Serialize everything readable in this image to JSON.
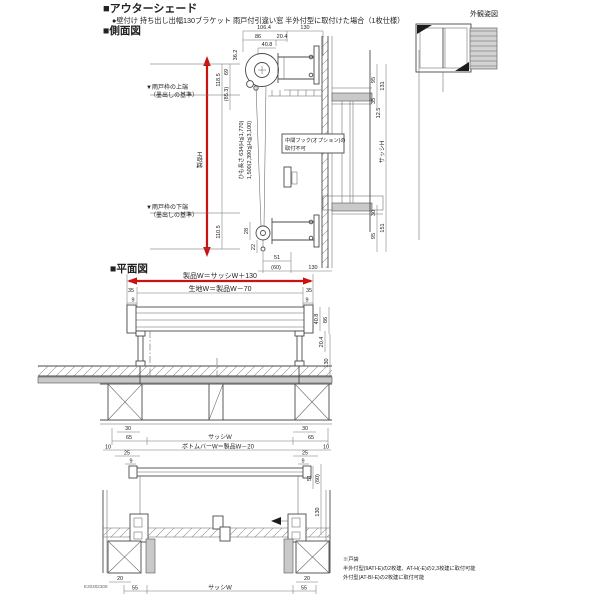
{
  "header": {
    "title": "■アウターシェード",
    "subtitle": "●壁付け 持ち出し出幅130ブラケット 雨戸付引違い窓 半外付型に取付けた場合（1枚仕様）",
    "side_section": "■側面図",
    "plan_section": "■平面図"
  },
  "appearance": {
    "label": "外観姿図"
  },
  "side": {
    "top_total": "106.4",
    "top_offset": "130",
    "top_86": "86",
    "top_20_4": "20.4",
    "top_40_8": "40.8",
    "left_36_2": "36.2",
    "left_118_5": "118.5",
    "left_69": "69",
    "left_85_3": "(85.3)",
    "left_110_5": "110.5",
    "product_h": "製品H",
    "sash_h": "サッシH",
    "datum_top_1": "▼雨戸枠の上端",
    "datum_top_2": "（墨出しの基準）",
    "datum_bottom_1": "▼雨戸枠の下端",
    "datum_bottom_2": "（墨出しの基準）",
    "cord_1": "ひも長さ 634(H≦1,770)",
    "cord_2": "1,500(2,390≦H≦3,100)",
    "hook_1": "中間フック(オプション)の",
    "hook_2": "取付不可",
    "right_95": "95",
    "right_131": "131",
    "right_35": "35",
    "right_12_5": "12.5",
    "right_30": "30",
    "right_151": "151",
    "right_95b": "95",
    "dim_28": "28",
    "dim_22": "22",
    "dim_51": "51",
    "dim_60": "(60)",
    "dim_130": "130"
  },
  "plan": {
    "product_w": "製品W＝サッシW＋130",
    "fabric_w": "生地W＝製品W－70",
    "l35": "35",
    "r35": "35",
    "l9": "9",
    "r9": "9",
    "r40_8": "40.8",
    "r86": "86",
    "r20_4": "20.4",
    "r130": "130",
    "l30": "30",
    "r30": "30",
    "l65": "65",
    "r65": "65",
    "sash_w": "サッシW",
    "l10": "10",
    "r10": "10",
    "bottom_bar": "ボトムバーW＝製品W－20",
    "l25": "25",
    "r25": "25",
    "l9b": "9",
    "r9b": "9",
    "r51": "51",
    "r60": "(60)",
    "r130b": "130",
    "l20": "20",
    "r20": "20",
    "l55": "55",
    "r55": "55",
    "sash_w_b": "サッシW",
    "code": "E20302308"
  },
  "notes": {
    "l1": "※戸袋",
    "l2": "半外付型(9ATI-E)の2枚建、AT-H(-E)の2,3枚建に取付可能",
    "l3": "外付型(AT-BI-E)の2枚建に取付可能"
  },
  "colors": {
    "accent_red": "#cb1212",
    "line": "#4a4a4a",
    "fill_gray": "#c9c9c9"
  }
}
